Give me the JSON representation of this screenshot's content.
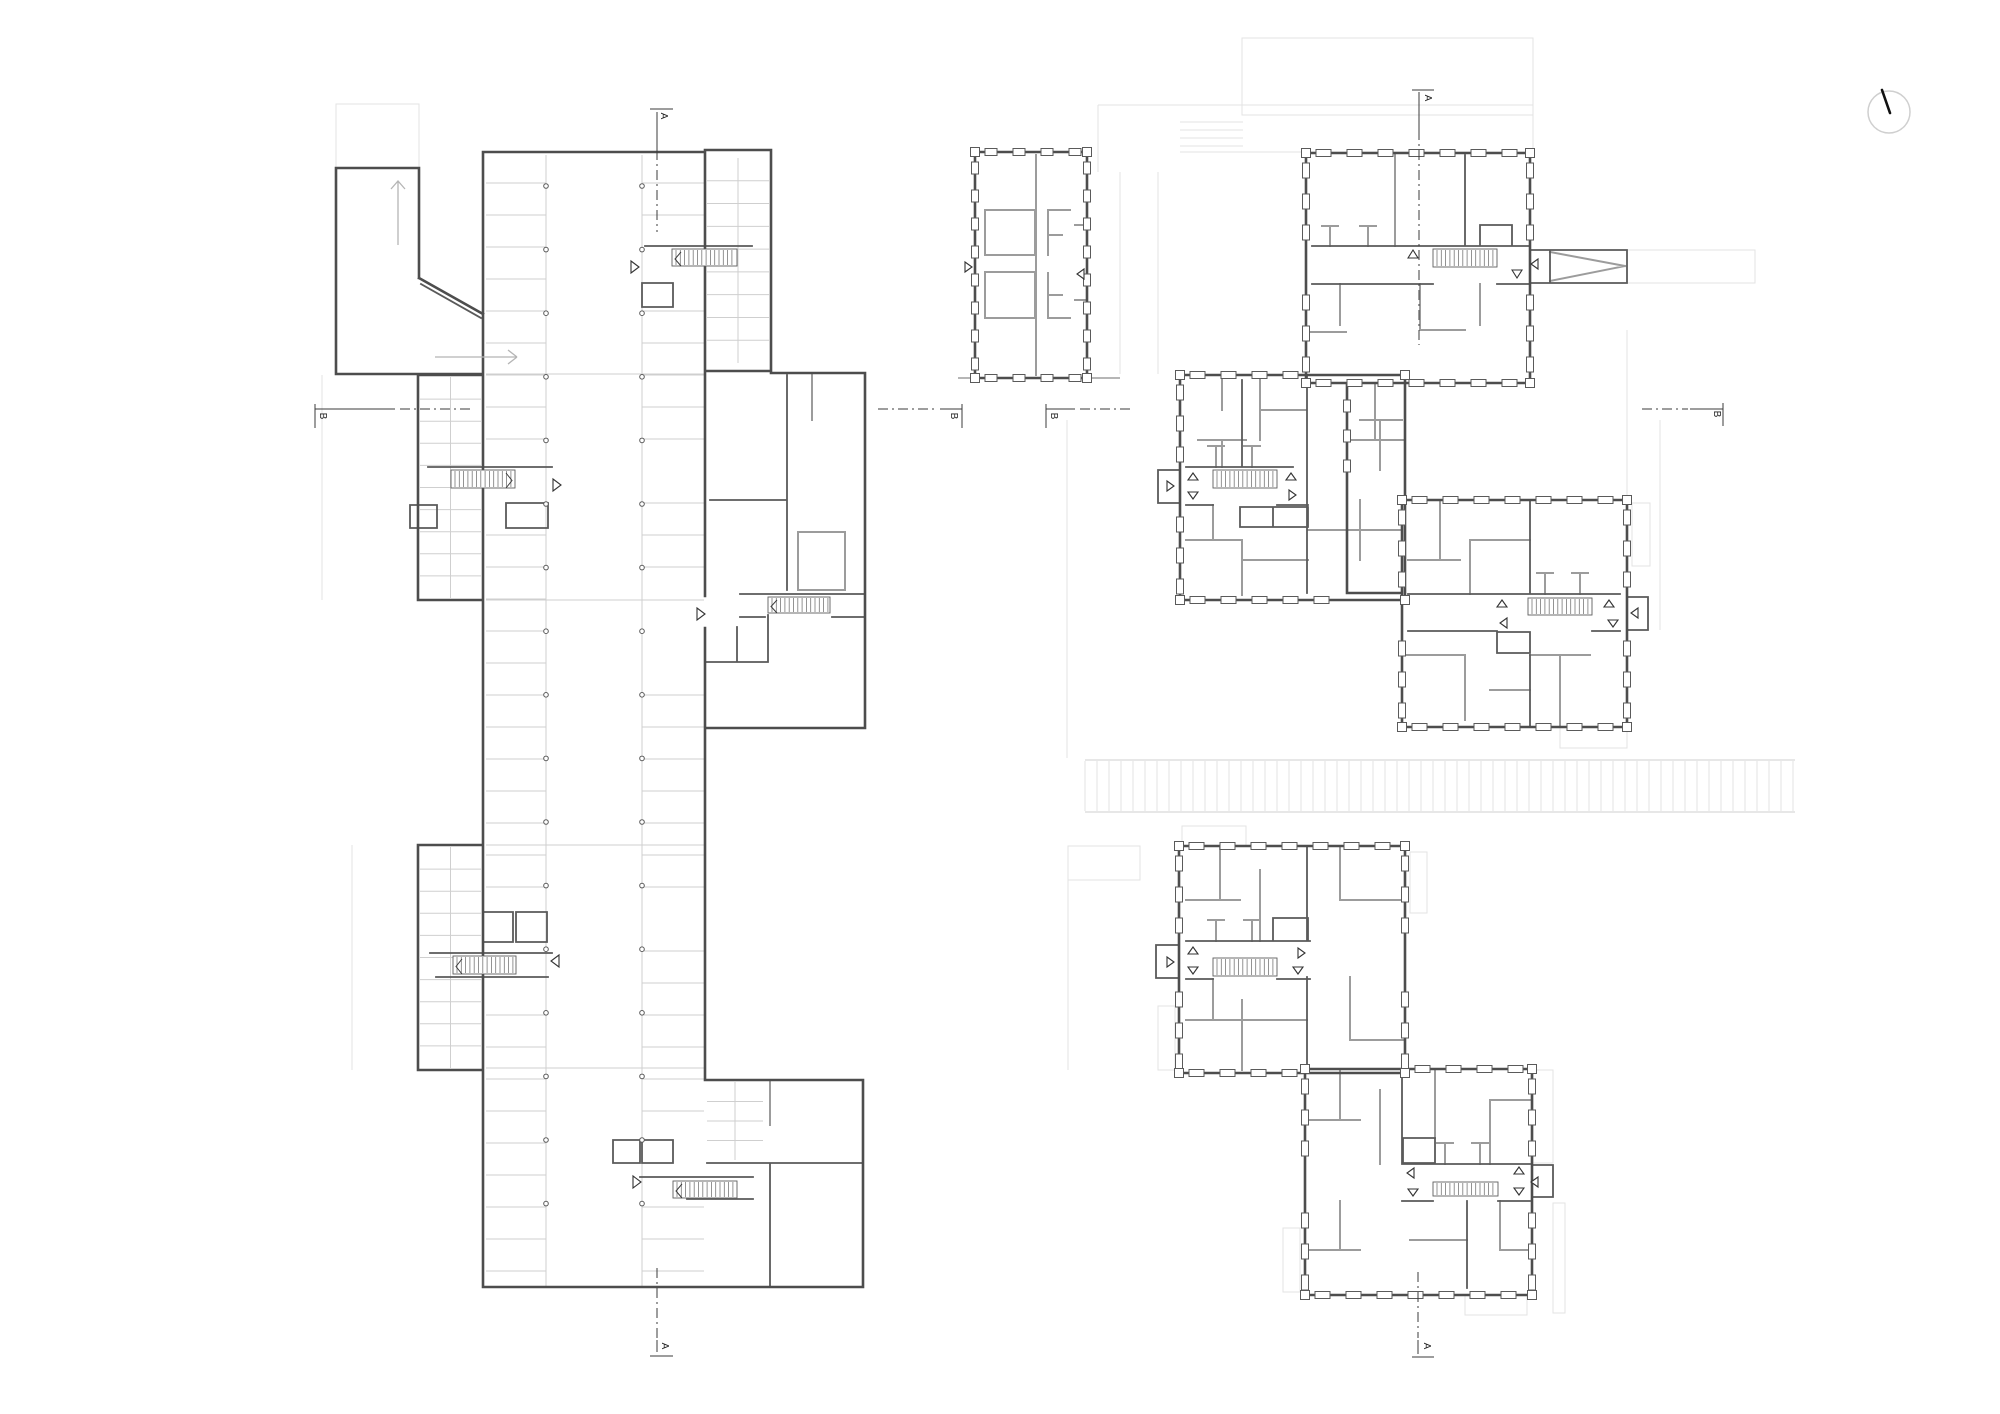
{
  "drawing": {
    "type": "architectural floor plans",
    "panels": {
      "garage": {
        "description": "basement / parking level plan with ramp, parking bays, storage cells and four stair cores",
        "section_labels": {
          "a_top": "A",
          "a_bottom": "A",
          "b_left": "B",
          "b_right": "B"
        }
      },
      "upper": {
        "description": "upper level plan: one detached block and five linked apartment blocks with stairs",
        "section_labels": {
          "a_top": "A",
          "a_bottom": "A",
          "b_left": "B",
          "b_right": "B"
        }
      }
    },
    "north_indicator": {
      "icon": "north-needle-icon"
    }
  },
  "colors": {
    "background": "#ffffff",
    "wall_dark": "#4d4d4d",
    "wall_medium": "#5a5a5a",
    "partition_gray": "#9c9c9c",
    "line_light": "#cfcfcf",
    "line_faint": "#e3e3e3",
    "marker": "#3b3b3b",
    "north_needle": "#111111",
    "north_ring": "#cccccc"
  }
}
